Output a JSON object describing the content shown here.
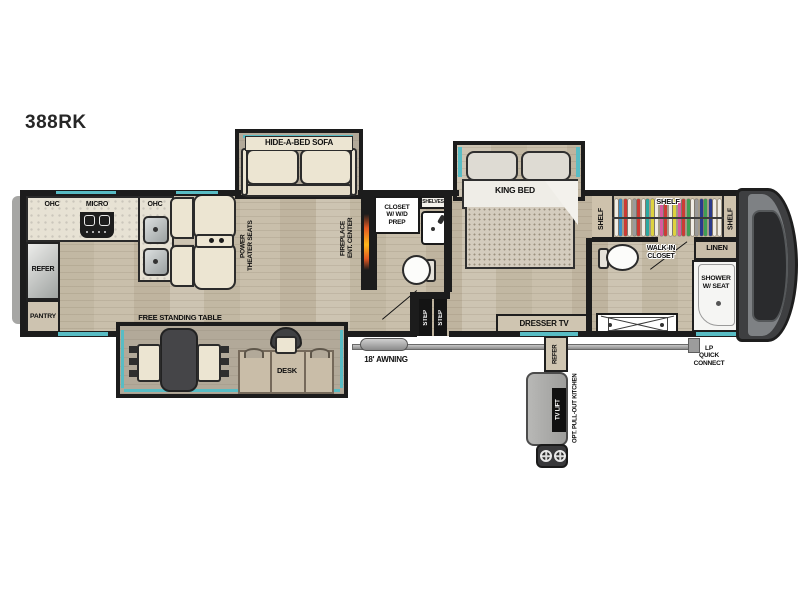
{
  "model_label": "388RK",
  "kitchen": {
    "ohc_left": "OHC",
    "micro": "MICRO",
    "ohc_right": "OHC",
    "refer": "REFER",
    "pantry": "PANTRY"
  },
  "living": {
    "sofa": "HIDE-A-BED SOFA",
    "theater_seats": "POWER\nTHEATER SEATS",
    "fireplace": "FIREPLACE\nENT. CENTER",
    "free_table": "FREE STANDING TABLE",
    "desk": "DESK"
  },
  "mid_bath": {
    "wd_closet": "CLOSET\nW/ W/D\nPREP",
    "shelves": "SHELVES",
    "step_1": "STEP",
    "step_2": "STEP"
  },
  "bedroom": {
    "king_bed": "KING BED",
    "dresser_tv": "DRESSER TV"
  },
  "front_closet": {
    "shelf_top": "SHELF",
    "shelf_left": "SHELF",
    "shelf_right": "SHELF",
    "walk_in": "WALK-IN\nCLOSET",
    "hanger_colors": [
      "#efece4",
      "#3a8fc7",
      "#cc3b35",
      "#efece4",
      "#9a9a9a",
      "#cc3b35",
      "#efece4",
      "#2aa8a0",
      "#ddd23f",
      "#efece4",
      "#d85a9e",
      "#cc3b35",
      "#efece4",
      "#ddd23f",
      "#d85a9e",
      "#cc3b35",
      "#3f9e54",
      "#efece4",
      "#9a9a9a",
      "#2a3a8c",
      "#3f9e54",
      "#2a3a8c",
      "#efece4",
      "#efece4"
    ]
  },
  "front_bath": {
    "linen": "LINEN",
    "shower": "SHOWER\nW/ SEAT"
  },
  "exterior": {
    "awning": "18' AWNING",
    "lp_quick_connect": "LP\nQUICK\nCONNECT",
    "pullout_refer": "REFER",
    "tv_lift": "TV LIFT",
    "pullout_kitchen": "OPT. PULL-OUT KITCHEN"
  },
  "colors": {
    "accent_teal": "#58bcc4",
    "wall_black": "#1c1c1c",
    "floor_wood": "#c8bfae",
    "slide_floor": "#b2a999",
    "cream_furniture": "#ece5d2",
    "tan_cabinet": "#cfc5b1",
    "table_dark": "#454548",
    "cap_gray": "#3e3f41",
    "fireplace_glow": "#ff8c1a"
  }
}
